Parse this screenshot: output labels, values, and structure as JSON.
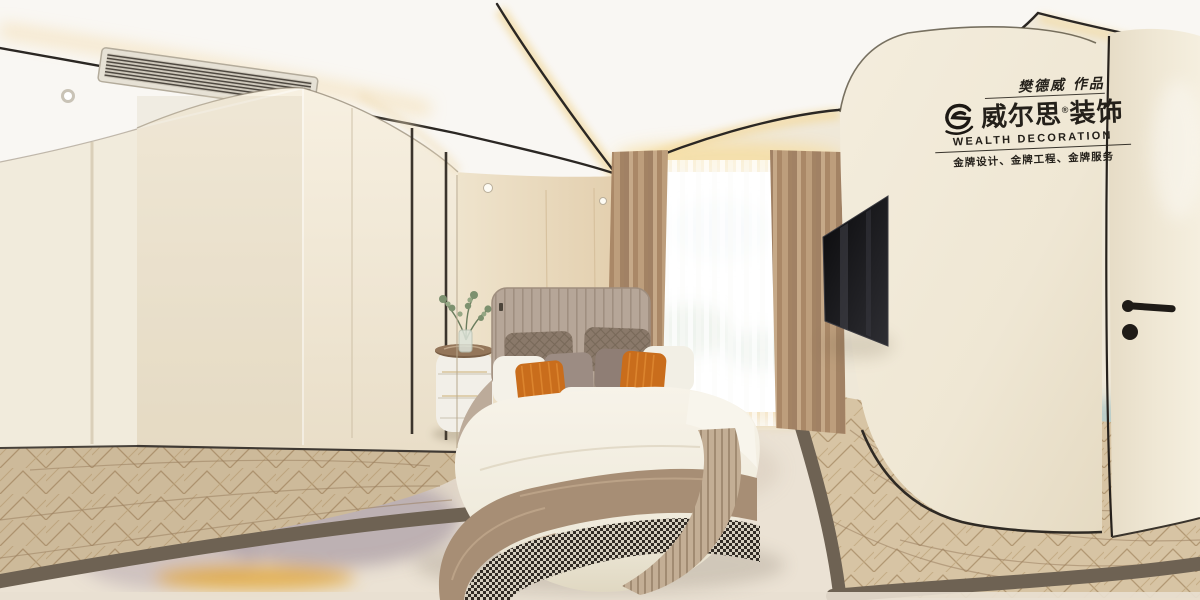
{
  "meta": {
    "kind": "360-degree equirectangular interior render",
    "scene": "modern cream-toned bedroom panorama: curved black ceiling trims, wardrobe, upholstered bed with orange accent pillows, sheer window, wall-mounted TV, cream door, herringbone wood floor with abstract watercolor rug"
  },
  "watermark": {
    "signature": "樊德威 作品",
    "brand_cn": "威尔思",
    "registered_mark": "®",
    "brand_type": "装饰",
    "brand_en": "WEALTH DECORATION",
    "tagline": "金牌设计、金牌工程、金牌服务"
  },
  "palette": {
    "ceiling_white": "#f9f7f3",
    "wall_cream": "#efe8d8",
    "back_wall_beige": "#e7d5b8",
    "trim_black": "#2b2723",
    "cove_glow": "#f3debb",
    "drape_tan": "#c2a183",
    "headboard_taupe": "#b4a496",
    "duvet_white": "#f3efe4",
    "throw_taupe": "#a78e75",
    "pillow_orange": "#c96d1c",
    "wood_floor": "#d7c4a4",
    "rug_cream": "#ebe2d4",
    "rug_border": "#6e6253",
    "rug_teal": "#4f93a3",
    "rug_purple": "#8f7f91",
    "rug_gold": "#e2a93e",
    "tv_black": "#101013"
  }
}
